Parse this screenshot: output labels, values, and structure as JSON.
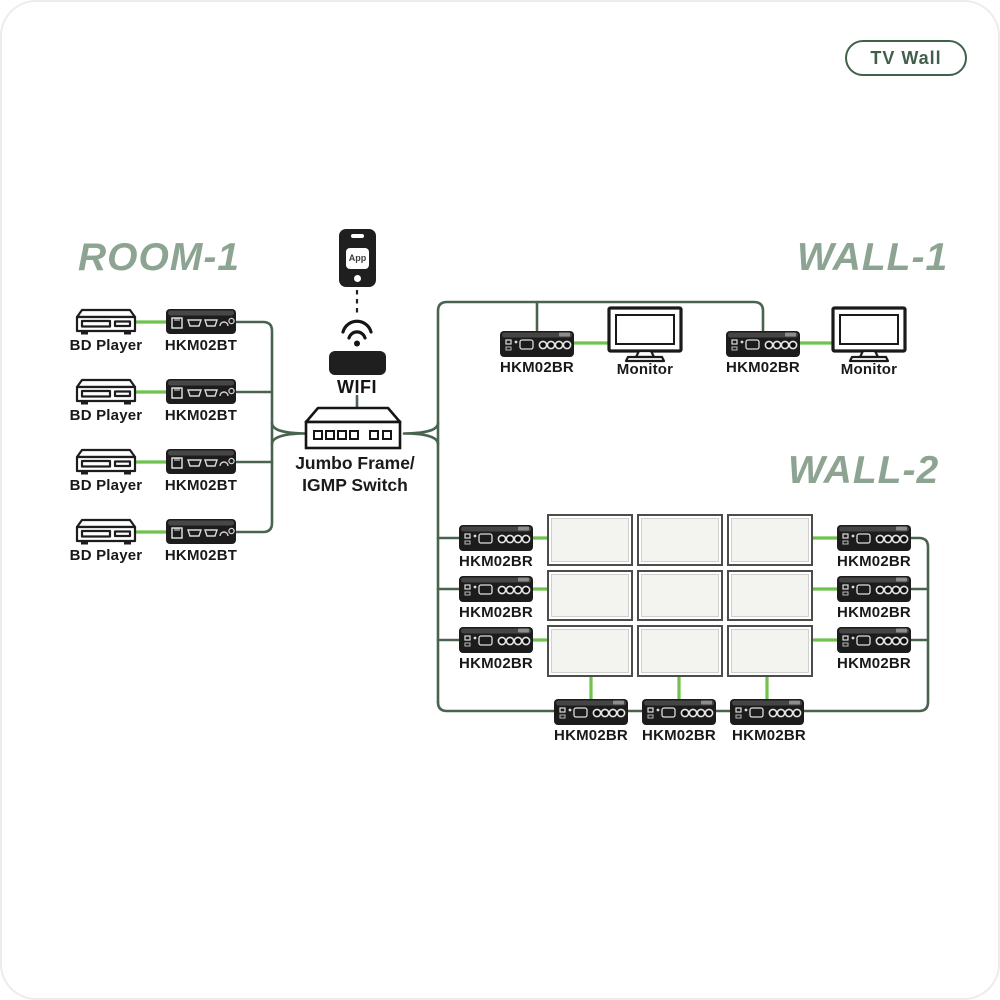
{
  "badge": {
    "label": "TV Wall"
  },
  "room1": {
    "title": "ROOM-1",
    "rows": [
      {
        "source": "BD Player",
        "transmitter": "HKM02BT"
      },
      {
        "source": "BD Player",
        "transmitter": "HKM02BT"
      },
      {
        "source": "BD Player",
        "transmitter": "HKM02BT"
      },
      {
        "source": "BD Player",
        "transmitter": "HKM02BT"
      }
    ]
  },
  "control": {
    "phone_app_label": "App",
    "wifi_label": "WIFI",
    "switch_label_line1": "Jumbo Frame/",
    "switch_label_line2": "IGMP Switch"
  },
  "wall1": {
    "title": "WALL-1",
    "pairs": [
      {
        "receiver": "HKM02BR",
        "display": "Monitor"
      },
      {
        "receiver": "HKM02BR",
        "display": "Monitor"
      }
    ]
  },
  "wall2": {
    "title": "WALL-2",
    "grid": {
      "rows": 3,
      "cols": 3
    },
    "left_receivers": [
      "HKM02BR",
      "HKM02BR",
      "HKM02BR"
    ],
    "right_receivers": [
      "HKM02BR",
      "HKM02BR",
      "HKM02BR"
    ],
    "bottom_receivers": [
      "HKM02BR",
      "HKM02BR",
      "HKM02BR"
    ]
  },
  "colors": {
    "bright_line": "#6fc24d",
    "dark_line": "#4a634f",
    "title_green": "#8ca491",
    "badge_green": "#41604a",
    "device_black": "#1c1c1c"
  }
}
